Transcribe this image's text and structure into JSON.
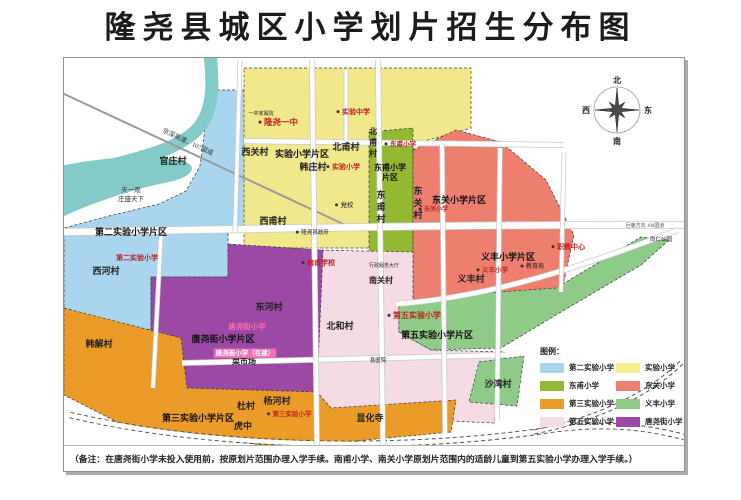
{
  "title": "隆尧县城区小学划片招生分布图",
  "note": "（备注：在唐尧街小学未投入使用前，按原划片范围办理入学手续。南甫小学、南关小学原划片范围内的适龄儿童到第五实验小学办理入学手续。）",
  "compass": {
    "cx": 553,
    "cy": 52,
    "labels": {
      "north": "北",
      "south": "南",
      "east": "东",
      "west": "西"
    }
  },
  "legend": {
    "title": "图例：",
    "items": [
      {
        "label": "第二实验小学",
        "color": "#a9d5ee"
      },
      {
        "label": "实验小学",
        "color": "#f5ee8e"
      },
      {
        "label": "东甫小学",
        "color": "#93b832"
      },
      {
        "label": "东关小学",
        "color": "#ee7e6e"
      },
      {
        "label": "第三实验小学",
        "color": "#eb9c28"
      },
      {
        "label": "义丰小学",
        "color": "#8dcb87"
      },
      {
        "label": "第五实验小学",
        "color": "#f4dde6"
      },
      {
        "label": "唐尧街小学",
        "color": "#9c48a5"
      }
    ]
  },
  "map": {
    "zones": [
      {
        "id": "dier-shiyan",
        "fill": "#a9d5ee",
        "points": "143,32 182,32 182,174 164,174 164,219 87,219 87,272 0,257 0,170 45,158 95,146 122,133 136,108 141,70"
      },
      {
        "id": "shiyan",
        "fill": "#f1e88b",
        "points": "180,10 407,10 407,70 350,86 344,190 180,190"
      },
      {
        "id": "dongfu",
        "fill": "#93b832",
        "points": "305,74 349,70 349,210 305,212"
      },
      {
        "id": "dongguan",
        "fill": "#ee7e6e",
        "points": "349,92 392,72 437,84 482,122 510,177 497,237 349,242"
      },
      {
        "id": "diwu-shiyan",
        "fill": "#f4dbe4",
        "points": "247,192 349,194 349,242 335,244 335,274 367,292 440,294 430,365 257,357 247,312"
      },
      {
        "id": "yifeng",
        "fill": "#8dcb87",
        "points": "335,244 407,236 492,230 577,179 605,182 577,207 492,257 437,290 367,292 335,274"
      },
      {
        "id": "yifeng-shawan",
        "fill": "#8dcb87",
        "points": "415,304 460,298 453,348 405,344"
      },
      {
        "id": "tangyaojie",
        "fill": "#9c48a5",
        "points": "164,186 259,192 253,334 123,330 87,272 87,219 164,219"
      },
      {
        "id": "disan-shiyan",
        "fill": "#eb9c28",
        "points": "0,250 117,280 123,330 253,334 267,350 392,342 387,374 217,390 57,366 0,337"
      }
    ],
    "river": {
      "color": "#82cbc8",
      "stream": "M146,-4 C150,30 148,52 136,68 C122,86 95,95 60,104 C38,110 15,116 -4,124",
      "lake": "M-4,108 C35,100 80,96 115,102 C135,106 132,118 105,124 C65,132 25,146 -4,160 Z"
    },
    "highway": {
      "d": "M-2,35 L292,172",
      "label": "京深高速、107国道",
      "lx": 98,
      "ly": 74,
      "angle": 25
    },
    "roads": [
      {
        "d": "M180 83 L500 87",
        "w": 4.5
      },
      {
        "d": "M-2 174 C200 171 420 166 622 167",
        "w": 6.5
      },
      {
        "d": "M332 246 C430 239 525 206 614 172",
        "w": 4.5
      },
      {
        "d": "M118 305 L442 297",
        "w": 4.5
      },
      {
        "d": "M6 357 C150 391 340 393 478 373 C545 363 585 370 620 379",
        "w": 4.5,
        "e": true
      },
      {
        "d": "M176 2 L171 174",
        "w": 3.5
      },
      {
        "d": "M248 2 L253 390",
        "w": 4.5
      },
      {
        "d": "M314 2 L319 392",
        "w": 4.5
      },
      {
        "d": "M282 12 L282 84",
        "w": 3
      },
      {
        "d": "M378 86 L381 376",
        "w": 4
      },
      {
        "d": "M436 90 L433 362",
        "w": 4
      },
      {
        "d": "M97 176 L89 330",
        "w": 3.5
      },
      {
        "d": "M500 94 L497 234",
        "w": 3.5
      },
      {
        "d": "M470 374 C540 360 590 332 618 304",
        "w": 3,
        "e": true
      }
    ],
    "labels": [
      {
        "t": "第二实验小学片区",
        "x": 67,
        "y": 177,
        "s": 9,
        "f": "sans",
        "b": true,
        "c": "#111",
        "n": "district-label"
      },
      {
        "t": "实验小学片区",
        "x": 238,
        "y": 99,
        "s": 9,
        "f": "sans",
        "b": true,
        "c": "#111",
        "n": "district-label"
      },
      {
        "t": "东甫小学",
        "x": 326,
        "y": 112,
        "s": 8,
        "f": "sans",
        "b": true,
        "c": "#111",
        "n": "district-label"
      },
      {
        "t": "片区",
        "x": 326,
        "y": 122,
        "s": 8,
        "f": "sans",
        "b": true,
        "c": "#111",
        "n": "district-label"
      },
      {
        "t": "东关小学片区",
        "x": 395,
        "y": 145,
        "s": 9,
        "f": "sans",
        "b": true,
        "c": "#111",
        "n": "district-label"
      },
      {
        "t": "义丰小学片区",
        "x": 444,
        "y": 202,
        "s": 9,
        "f": "sans",
        "b": true,
        "c": "#111",
        "n": "district-label"
      },
      {
        "t": "第五实验小学片区",
        "x": 373,
        "y": 280,
        "s": 9,
        "f": "sans",
        "b": true,
        "c": "#111",
        "n": "district-label"
      },
      {
        "t": "第三实验小学片区",
        "x": 134,
        "y": 363,
        "s": 9,
        "f": "sans",
        "b": true,
        "c": "#111",
        "n": "district-label"
      },
      {
        "t": "唐尧街小学片区",
        "x": 159,
        "y": 284,
        "s": 9,
        "f": "sans",
        "b": true,
        "c": "#111",
        "n": "district-label"
      },
      {
        "t": "官庄村",
        "x": 109,
        "y": 106,
        "s": 9,
        "f": "serif",
        "b": true,
        "c": "#222",
        "n": "village-label"
      },
      {
        "t": "西关村",
        "x": 191,
        "y": 97,
        "s": 9,
        "f": "serif",
        "b": true,
        "c": "#222",
        "n": "village-label"
      },
      {
        "t": "韩庄村",
        "x": 249,
        "y": 112,
        "s": 9,
        "f": "serif",
        "b": true,
        "c": "#222",
        "n": "village-label"
      },
      {
        "t": "北甫村",
        "x": 282,
        "y": 92,
        "s": 9,
        "f": "serif",
        "b": true,
        "c": "#222",
        "n": "village-label"
      },
      {
        "t": "北甫村",
        "x": 309,
        "y": 76,
        "s": 8,
        "f": "serif",
        "b": true,
        "c": "#222",
        "v": true,
        "n": "village-label"
      },
      {
        "t": "西甫村",
        "x": 209,
        "y": 166,
        "s": 9,
        "f": "serif",
        "b": true,
        "c": "#222",
        "n": "village-label"
      },
      {
        "t": "东甫村",
        "x": 317,
        "y": 140,
        "s": 9,
        "f": "serif",
        "b": true,
        "c": "#222",
        "v": true,
        "n": "village-label"
      },
      {
        "t": "东关村",
        "x": 354,
        "y": 136,
        "s": 9,
        "f": "serif",
        "b": true,
        "c": "#222",
        "v": true,
        "n": "village-label"
      },
      {
        "t": "西河村",
        "x": 42,
        "y": 216,
        "s": 9,
        "f": "serif",
        "b": true,
        "c": "#222",
        "n": "village-label"
      },
      {
        "t": "东河村",
        "x": 205,
        "y": 252,
        "s": 9,
        "f": "serif",
        "b": true,
        "c": "#222",
        "n": "village-label"
      },
      {
        "t": "北和村",
        "x": 276,
        "y": 271,
        "s": 9,
        "f": "serif",
        "b": true,
        "c": "#222",
        "n": "village-label"
      },
      {
        "t": "南关村",
        "x": 317,
        "y": 225,
        "s": 8,
        "f": "serif",
        "b": true,
        "c": "#222",
        "n": "village-label"
      },
      {
        "t": "义丰村",
        "x": 407,
        "y": 224,
        "s": 9,
        "f": "serif",
        "b": true,
        "c": "#222",
        "n": "village-label"
      },
      {
        "t": "沙湾村",
        "x": 434,
        "y": 329,
        "s": 9,
        "f": "serif",
        "b": true,
        "c": "#222",
        "n": "village-label"
      },
      {
        "t": "韩解村",
        "x": 35,
        "y": 289,
        "s": 9,
        "f": "serif",
        "b": true,
        "c": "#222",
        "n": "village-label"
      },
      {
        "t": "杜村",
        "x": 182,
        "y": 351,
        "s": 9,
        "f": "serif",
        "b": true,
        "c": "#222",
        "n": "village-label"
      },
      {
        "t": "虎中",
        "x": 179,
        "y": 371,
        "s": 9,
        "f": "serif",
        "b": true,
        "c": "#222",
        "n": "village-label"
      },
      {
        "t": "杨河村",
        "x": 213,
        "y": 346,
        "s": 9,
        "f": "serif",
        "b": true,
        "c": "#222",
        "n": "village-label"
      },
      {
        "t": "显化寺",
        "x": 306,
        "y": 363,
        "s": 9,
        "f": "serif",
        "b": true,
        "c": "#222",
        "n": "village-label"
      },
      {
        "t": "菜市场",
        "x": 180,
        "y": 306,
        "s": 8,
        "f": "serif",
        "b": true,
        "c": "#222",
        "n": "poi-label"
      },
      {
        "t": "天一观",
        "x": 67,
        "y": 134,
        "s": 6.5,
        "f": "serif",
        "b": false,
        "c": "#333",
        "n": "poi-label"
      },
      {
        "t": "庄盛天下",
        "x": 67,
        "y": 143,
        "s": 6.5,
        "f": "serif",
        "b": false,
        "c": "#333",
        "n": "poi-label"
      },
      {
        "t": "隆尧一中",
        "x": 217,
        "y": 67,
        "s": 8.5,
        "f": "serif",
        "b": true,
        "c": "#c22222",
        "dot": true,
        "n": "school-label"
      },
      {
        "t": "实验中学",
        "x": 292,
        "y": 56,
        "s": 7,
        "f": "serif",
        "b": true,
        "c": "#c22222",
        "dot": true,
        "n": "school-label"
      },
      {
        "t": "实验小学",
        "x": 282,
        "y": 111,
        "s": 7,
        "f": "serif",
        "b": true,
        "c": "#c22222",
        "dot": true,
        "n": "school-label"
      },
      {
        "t": "东甫小学",
        "x": 339,
        "y": 88,
        "s": 6.5,
        "f": "serif",
        "b": true,
        "c": "#c22222",
        "dot": true,
        "n": "school-label"
      },
      {
        "t": "东关小学",
        "x": 372,
        "y": 153,
        "s": 6,
        "f": "serif",
        "b": true,
        "c": "#c22222",
        "dot": true,
        "n": "school-label"
      },
      {
        "t": "义丰小学",
        "x": 431,
        "y": 214,
        "s": 6.5,
        "f": "serif",
        "b": true,
        "c": "#c22222",
        "dot": true,
        "n": "school-label"
      },
      {
        "t": "职教中心",
        "x": 507,
        "y": 191,
        "s": 7,
        "f": "serif",
        "b": true,
        "c": "#c22222",
        "dot": true,
        "n": "school-label"
      },
      {
        "t": "第五实验小学",
        "x": 353,
        "y": 260,
        "s": 8,
        "f": "serif",
        "b": true,
        "c": "#c22222",
        "dot": true,
        "n": "school-label"
      },
      {
        "t": "第二实验小学",
        "x": 73,
        "y": 202,
        "s": 7,
        "f": "serif",
        "b": true,
        "c": "#c22222",
        "n": "school-label"
      },
      {
        "t": "南甫学校",
        "x": 257,
        "y": 207,
        "s": 7,
        "f": "serif",
        "b": true,
        "c": "#c22222",
        "dot": true,
        "n": "school-label"
      },
      {
        "t": "第三实验小学",
        "x": 228,
        "y": 358,
        "s": 6.5,
        "f": "serif",
        "b": true,
        "c": "#c22222",
        "dot": true,
        "n": "school-label"
      },
      {
        "t": "唐尧街小学",
        "x": 183,
        "y": 271,
        "s": 7.5,
        "f": "serif",
        "b": true,
        "c": "#f66bb2",
        "n": "school-label"
      },
      {
        "t": "唐尧街小学（在建）",
        "x": 181,
        "y": 297,
        "s": 6.5,
        "f": "serif",
        "b": true,
        "c": "#ffffff",
        "bg": "#ef6eb8",
        "n": "school-label"
      },
      {
        "t": "党校",
        "x": 283,
        "y": 149,
        "s": 6.5,
        "f": "serif",
        "b": false,
        "c": "#222",
        "dot": true,
        "n": "poi-label"
      },
      {
        "t": "隆尧县政府",
        "x": 251,
        "y": 176,
        "s": 5.5,
        "f": "serif",
        "b": false,
        "c": "#222",
        "dot": true,
        "n": "poi-label"
      },
      {
        "t": "教育局",
        "x": 471,
        "y": 210,
        "s": 6,
        "f": "serif",
        "b": false,
        "c": "#222",
        "dot": true,
        "n": "poi-label"
      },
      {
        "t": "尚仁公园",
        "x": 597,
        "y": 183,
        "s": 5.5,
        "f": "serif",
        "b": false,
        "c": "#222",
        "n": "poi-label"
      },
      {
        "t": "县医院",
        "x": 314,
        "y": 304,
        "s": 5.5,
        "f": "serif",
        "b": false,
        "c": "#222",
        "n": "poi-label"
      },
      {
        "t": "行政服务大厅",
        "x": 320,
        "y": 209,
        "s": 5,
        "f": "serif",
        "b": false,
        "c": "#222",
        "n": "poi-label"
      },
      {
        "t": "一中家属院",
        "x": 197,
        "y": 57,
        "s": 5,
        "f": "serif",
        "b": false,
        "c": "#222",
        "n": "poi-label"
      },
      {
        "t": "巨鹿方向  108国道",
        "x": 581,
        "y": 169,
        "s": 5,
        "f": "serif",
        "b": false,
        "c": "#555",
        "n": "road-label"
      }
    ]
  }
}
